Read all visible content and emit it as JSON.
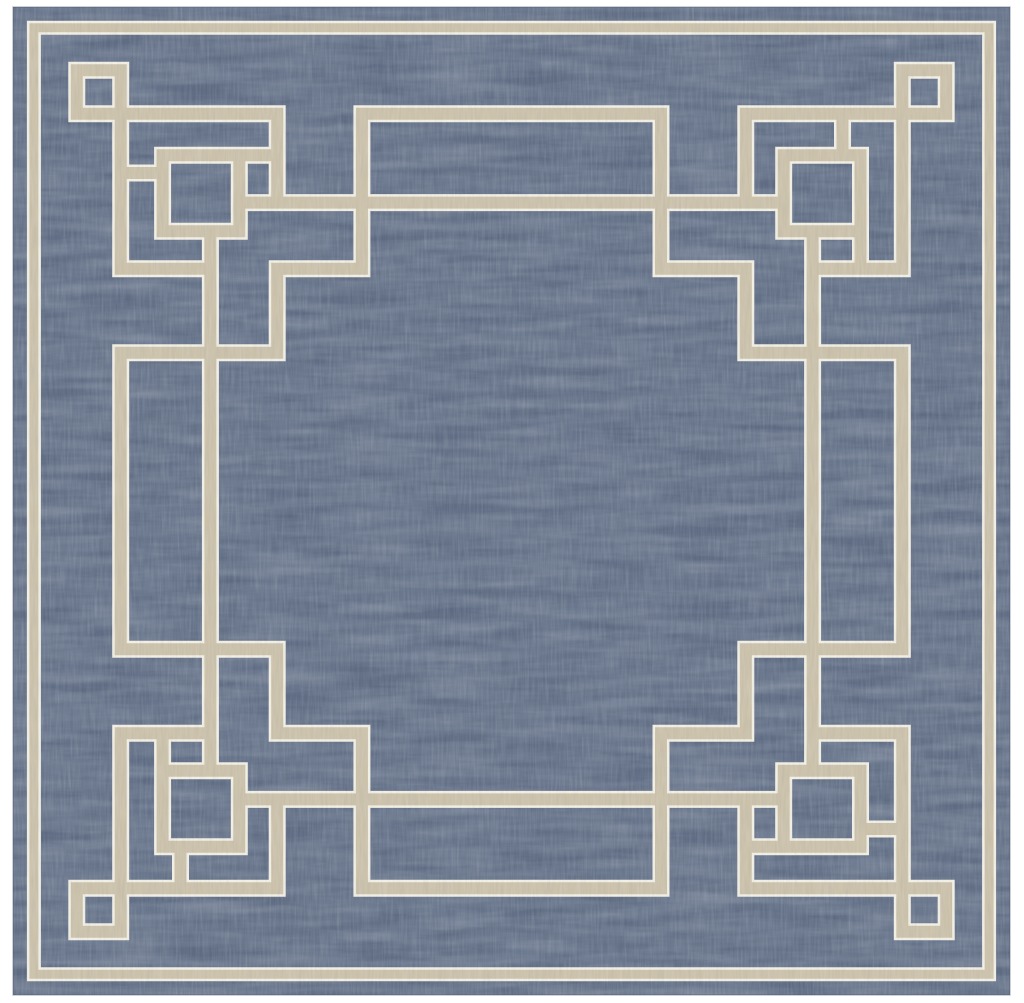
{
  "image": {
    "width": 1024,
    "height": 1003
  },
  "colors": {
    "page_background": "#ffffff",
    "rug_blue": "#5d6a81",
    "line_tan": "#ccc2ab",
    "line_cream": "#f2efe4",
    "rug_edge": "#46536a"
  },
  "texture": {
    "heather_light": "#aab3c2",
    "heather_dark": "#2e3c55",
    "rib_light": "#e9ecf2",
    "rib_dark": "#233049",
    "heather_light_opacity": 0.4,
    "heather_dark_opacity": 0.28,
    "rib_light_opacity": 0.2,
    "rib_dark_opacity": 0.14
  },
  "rug": {
    "x": 13,
    "y": 7,
    "width": 997,
    "height": 988
  },
  "pattern": {
    "unit_size": 1000,
    "rotations": 4,
    "line": {
      "tan_width": 12,
      "halo_width": 17
    },
    "band": {
      "inset": 21,
      "tan_width": 9,
      "halo_width": 14
    },
    "elements": {
      "corner_box_small": {
        "closed": true,
        "points": [
          [
            64,
            64
          ],
          [
            108,
            64
          ],
          [
            108,
            108
          ],
          [
            64,
            108
          ]
        ]
      },
      "corner_box_large": {
        "closed": true,
        "points": [
          [
            150,
            150
          ],
          [
            227,
            150
          ],
          [
            227,
            227
          ],
          [
            150,
            227
          ]
        ]
      },
      "corner_arm_top": {
        "closed": false,
        "points": [
          [
            108,
            108
          ],
          [
            265,
            108
          ],
          [
            265,
            198
          ]
        ]
      },
      "corner_arm_side": {
        "closed": false,
        "points": [
          [
            108,
            108
          ],
          [
            108,
            265
          ],
          [
            198,
            265
          ]
        ]
      },
      "box_edge_extension": {
        "closed": false,
        "points": [
          [
            227,
            150
          ],
          [
            265,
            150
          ]
        ]
      },
      "box_connector": {
        "closed": false,
        "points": [
          [
            108,
            168
          ],
          [
            150,
            168
          ]
        ]
      },
      "long_inset_line": {
        "closed": false,
        "points": [
          [
            227,
            198
          ],
          [
            773,
            198
          ]
        ]
      },
      "edge_rectangle": {
        "closed": false,
        "points": [
          [
            350,
            198
          ],
          [
            350,
            108
          ],
          [
            650,
            108
          ],
          [
            650,
            198
          ]
        ]
      },
      "staircase_link": {
        "closed": false,
        "points": [
          [
            350,
            198
          ],
          [
            350,
            265
          ],
          [
            265,
            265
          ],
          [
            265,
            350
          ],
          [
            198,
            350
          ]
        ]
      }
    }
  }
}
